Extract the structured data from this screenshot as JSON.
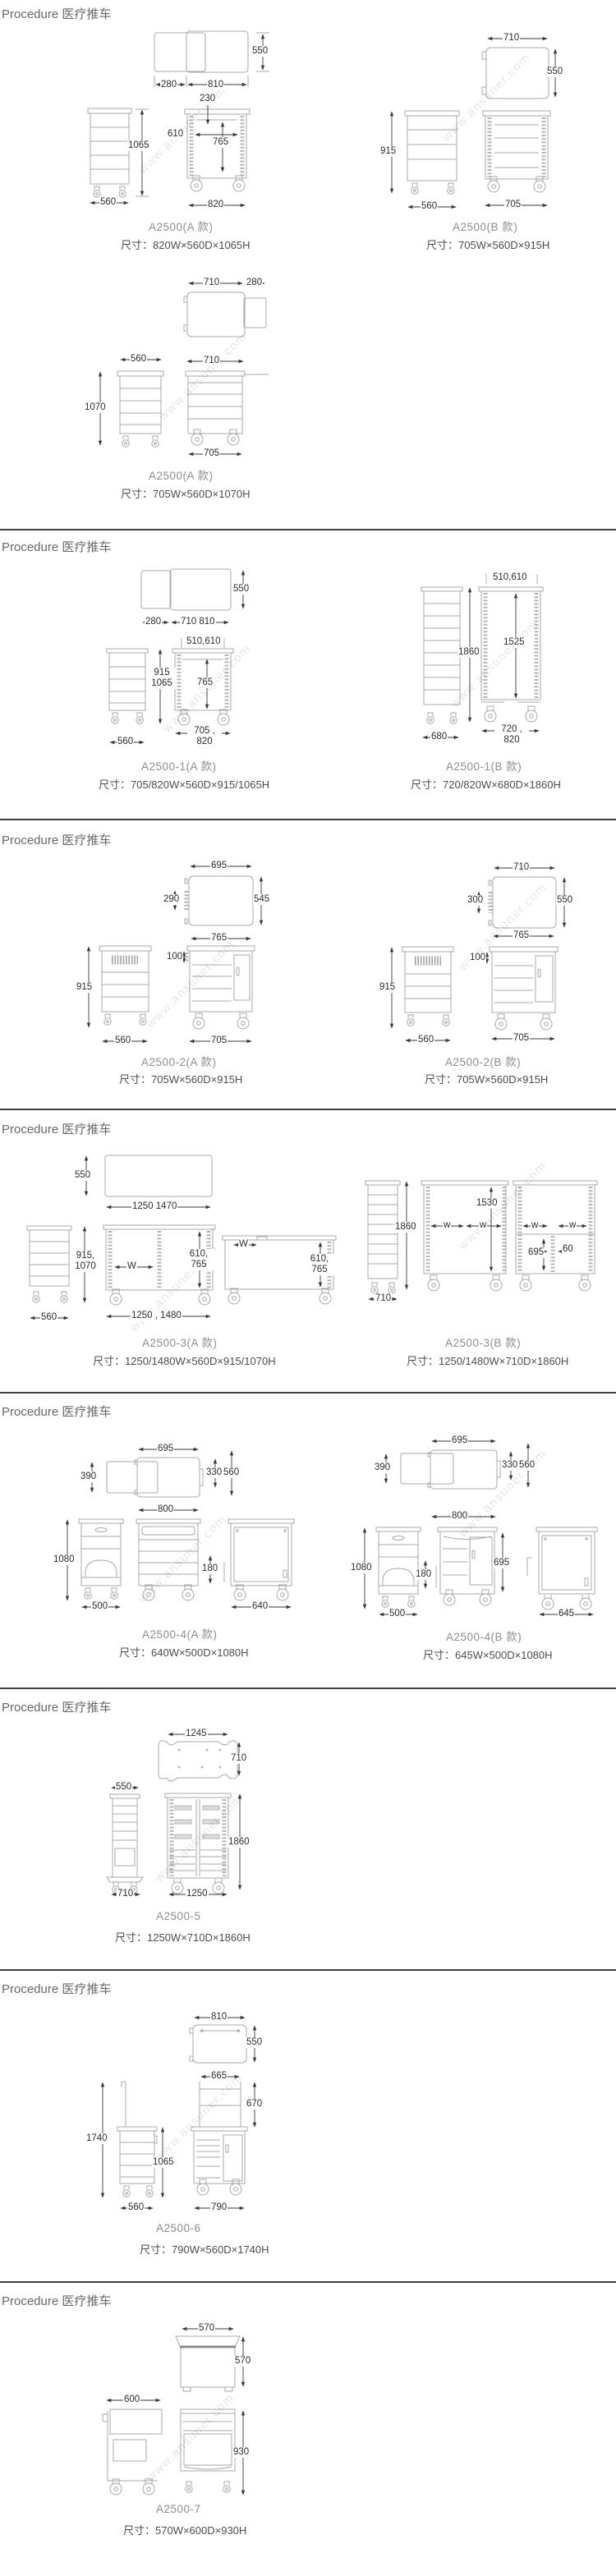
{
  "page": {
    "watermark": "www.ansuner.com"
  },
  "sections": [
    {
      "header": "Procedure 医疗推车",
      "figures": [
        {
          "model": "A2500(A 款)",
          "size": "尺寸：820W×560D×1065H",
          "dims": [
            "550",
            "280",
            "810",
            "230",
            "610",
            "765",
            "1065",
            "560",
            "820"
          ]
        },
        {
          "model": "A2500(B 款)",
          "size": "尺寸：705W×560D×915H",
          "dims": [
            "710",
            "550",
            "915",
            "560",
            "705"
          ]
        },
        {
          "model": "A2500(A 款)",
          "size": "尺寸：705W×560D×1070H",
          "dims": [
            "710",
            "280",
            "560",
            "1070",
            "710",
            "705"
          ]
        }
      ]
    },
    {
      "header": "Procedure 医疗推车",
      "figures": [
        {
          "model": "A2500-1(A 款)",
          "size": "尺寸：705/820W×560D×915/1065H",
          "dims": [
            "550",
            "280",
            "710 810",
            "510,610",
            "915\n1065",
            "765",
            "560",
            "705 ,\n820"
          ]
        },
        {
          "model": "A2500-1(B 款)",
          "size": "尺寸：720/820W×680D×1860H",
          "dims": [
            "510,610",
            "1860",
            "1525",
            "680",
            "720 ,\n820"
          ]
        }
      ]
    },
    {
      "header": "Procedure 医疗推车",
      "figures": [
        {
          "model": "A2500-2(A 款)",
          "size": "尺寸：705W×560D×915H",
          "dims": [
            "695",
            "290",
            "545",
            "765",
            "100",
            "915",
            "560",
            "705"
          ]
        },
        {
          "model": "A2500-2(B 款)",
          "size": "尺寸：705W×560D×915H",
          "dims": [
            "710",
            "300",
            "550",
            "765",
            "100",
            "915",
            "560",
            "705"
          ]
        }
      ]
    },
    {
      "header": "Procedure 医疗推车",
      "figures": [
        {
          "model": "A2500-3(A 款)",
          "size": "尺寸：1250/1480W×560D×915/1070H",
          "dims": [
            "550",
            "1250 1470",
            "915,\n1070",
            "W",
            "610,\n765",
            "560",
            "1250 , 1480",
            "W",
            "610,\n765"
          ]
        },
        {
          "model": "A2500-3(B 款)",
          "size": "尺寸：1250/1480W×710D×1860H",
          "dims": [
            "1860",
            "710",
            "1530",
            "w",
            "w",
            "w",
            "w",
            "695",
            "60"
          ]
        }
      ]
    },
    {
      "header": "Procedure 医疗推车",
      "figures": [
        {
          "model": "A2500-4(A 款)",
          "size": "尺寸：640W×500D×1080H",
          "dims": [
            "695",
            "390",
            "330",
            "560",
            "800",
            "1080",
            "180",
            "500",
            "640"
          ]
        },
        {
          "model": "A2500-4(B 款)",
          "size": "尺寸：645W×500D×1080H",
          "dims": [
            "695",
            "390",
            "330",
            "560",
            "800",
            "1080",
            "180",
            "695",
            "500",
            "645"
          ]
        }
      ]
    },
    {
      "header": "Procedure 医疗推车",
      "figures": [
        {
          "model": "A2500-5",
          "size": "尺寸：1250W×710D×1860H",
          "dims": [
            "1245",
            "710",
            "550",
            "1860",
            "710",
            "1250"
          ]
        }
      ]
    },
    {
      "header": "Procedure 医疗推车",
      "figures": [
        {
          "model": "A2500-6",
          "size": "尺寸：790W×560D×1740H",
          "dims": [
            "810",
            "550",
            "665",
            "670",
            "1740",
            "1065",
            "560",
            "790"
          ]
        }
      ]
    },
    {
      "header": "Procedure 医疗推车",
      "figures": [
        {
          "model": "A2500-7",
          "size": "尺寸：570W×600D×930H",
          "dims": [
            "570",
            "570",
            "600",
            "930"
          ]
        }
      ]
    }
  ]
}
